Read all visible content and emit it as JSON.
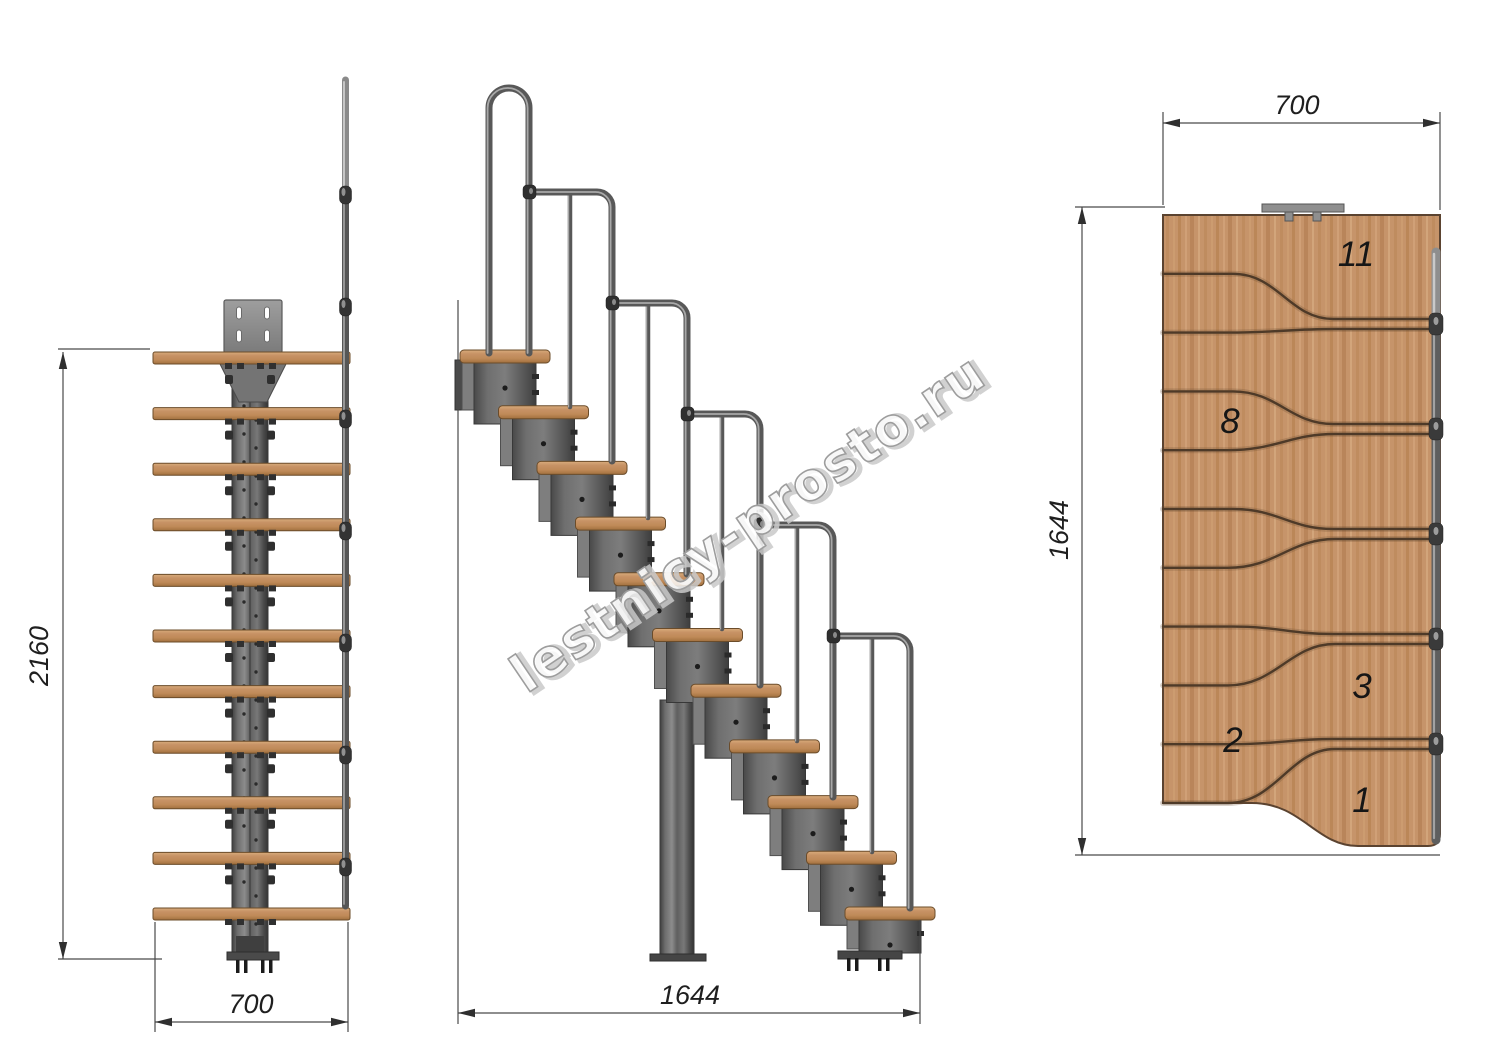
{
  "watermark": {
    "text": "lestnicy-prosto.ru"
  },
  "views": {
    "front": {
      "name": "front elevation",
      "dim_height": "2160",
      "dim_width": "700"
    },
    "side": {
      "name": "side elevation",
      "dim_length": "1644"
    },
    "plan": {
      "name": "top plan",
      "dim_width": "700",
      "dim_length": "1644",
      "tread_labels": [
        "11",
        "8",
        "3",
        "2",
        "1"
      ]
    }
  },
  "colors": {
    "wood": "#c6946a",
    "wood_outline": "#5b4330",
    "metal": "#6e6e6e",
    "metal_dark": "#3a3a3a",
    "rail": "#585858",
    "rail_highlight": "#a8a8a8",
    "dimension_line": "#4a4a4a",
    "dimension_text": "#1f1f1f",
    "watermark_outline": "#9d9d9d"
  }
}
